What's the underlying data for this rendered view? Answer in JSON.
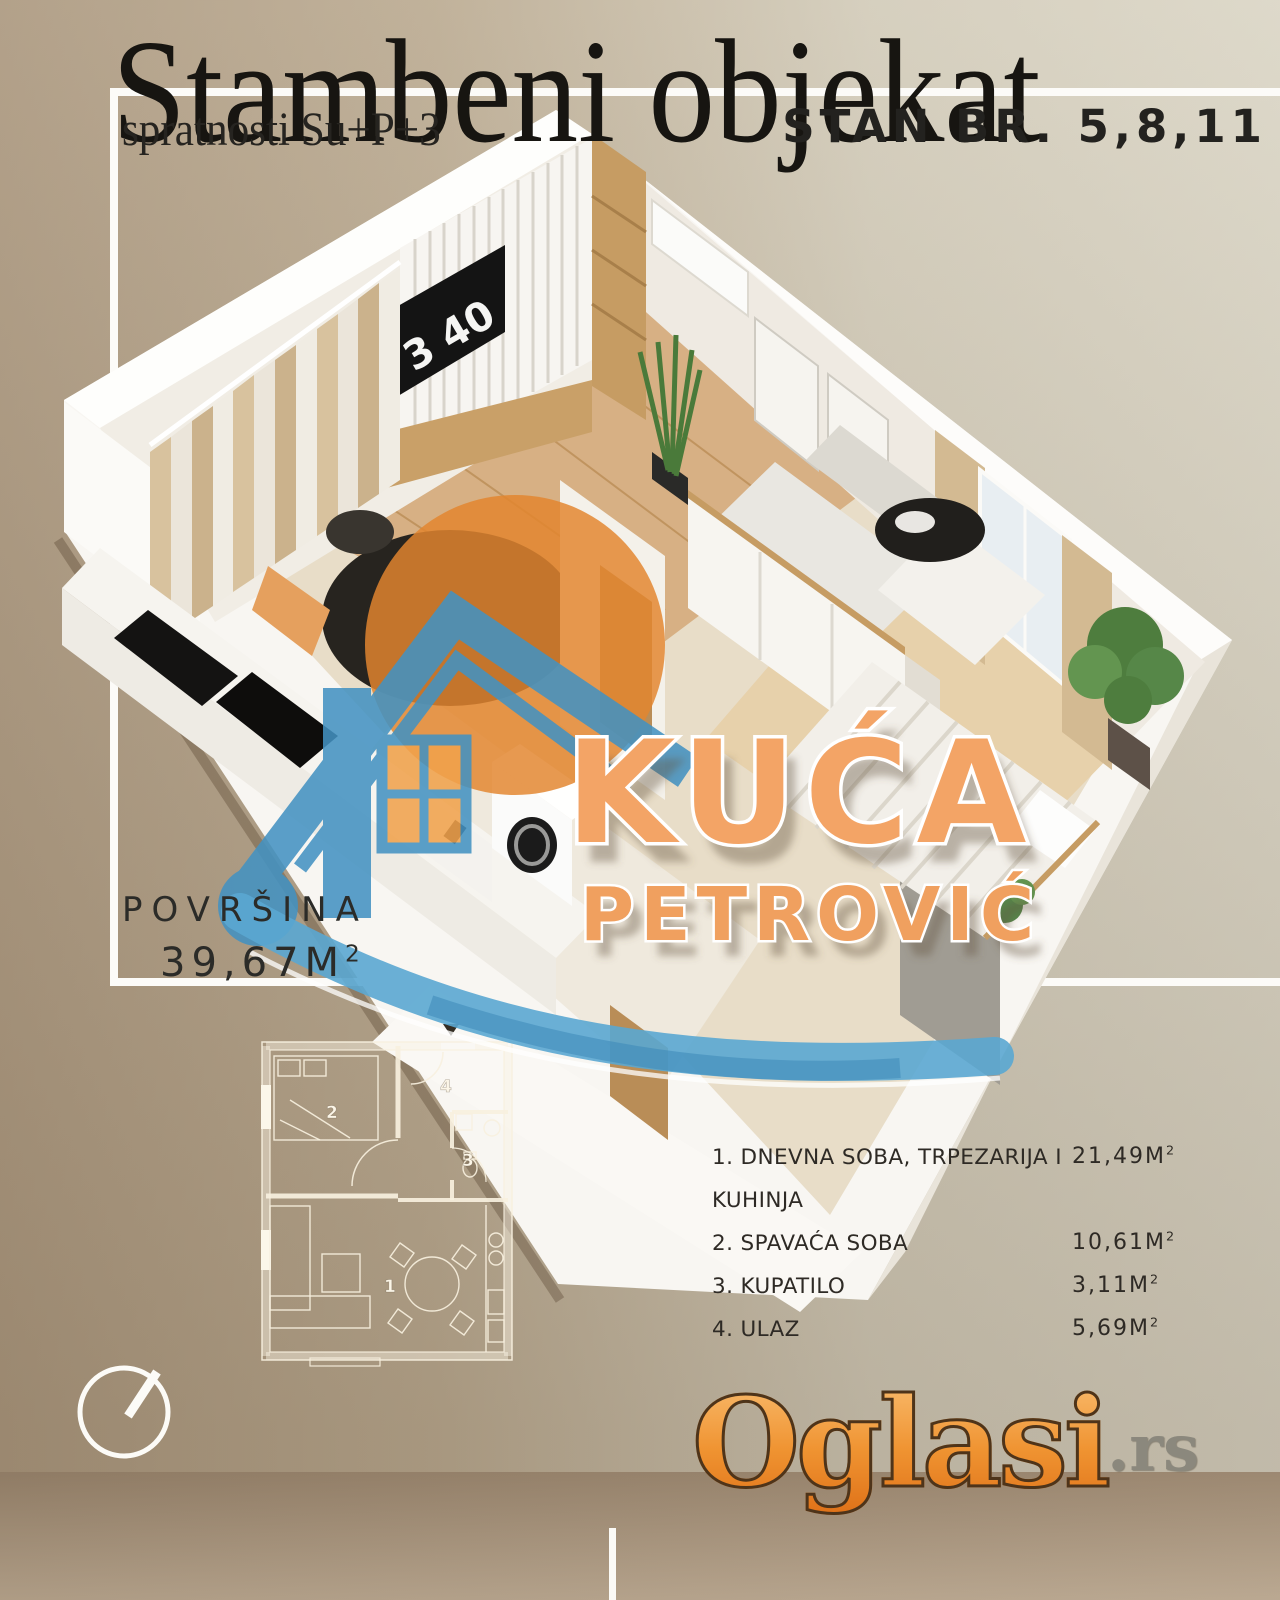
{
  "header": {
    "title": "Stambeni objekat",
    "subtitle": "spratnosti Su+P+3",
    "unit": "STAN BR. 5,8,11"
  },
  "area": {
    "label": "POVRŠINA",
    "value": "39,67M",
    "sup": "2"
  },
  "rooms": [
    {
      "label": "1. DNEVNA SOBA, TRPEZARIJA I KUHINJA",
      "value": "21,49M",
      "sup": "2"
    },
    {
      "label": "2. SPAVAĆA SOBA",
      "value": "10,61M",
      "sup": "2"
    },
    {
      "label": "3. KUPATILO",
      "value": "3,11M",
      "sup": "2"
    },
    {
      "label": "4. ULAZ",
      "value": "5,69M",
      "sup": "2"
    }
  ],
  "render": {
    "clock": "3 40"
  },
  "plan": {
    "labels": [
      "1",
      "2",
      "3",
      "4"
    ]
  },
  "watermark": {
    "line1": "KUĆA",
    "line2": "PETROVIĆ",
    "orange": "#f3a466",
    "blue": "#4392c2"
  },
  "logo": {
    "main": "Oglasi",
    "suffix": ".rs",
    "orange": "#ed8b2d",
    "gray": "#8b887d"
  },
  "colors": {
    "background_left": "#ad9a81",
    "background_right": "#dbd6c6",
    "bottom_band": "#a08a70",
    "frame_white": "#fcfbf8",
    "text_dark": "#23221f",
    "watermark_disc": "#e2862e"
  }
}
